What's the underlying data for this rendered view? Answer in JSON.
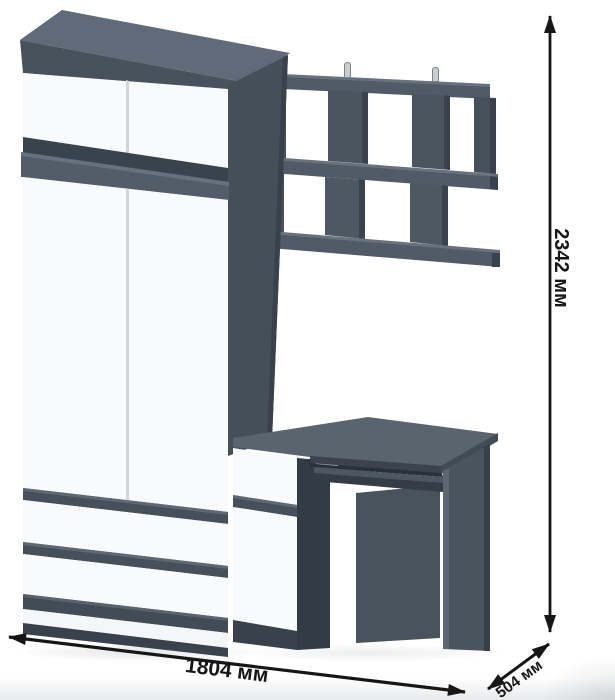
{
  "dimensions": {
    "height": "2342 мм",
    "width": "1804 мм",
    "depth": "504 мм"
  },
  "palette": {
    "graphite": "#47515c",
    "graphite_dark": "#39424b",
    "graphite_light": "#5f6b78",
    "front_white": "#f9fafb",
    "dimension_ink": "#161616",
    "background": "#ffffff"
  }
}
